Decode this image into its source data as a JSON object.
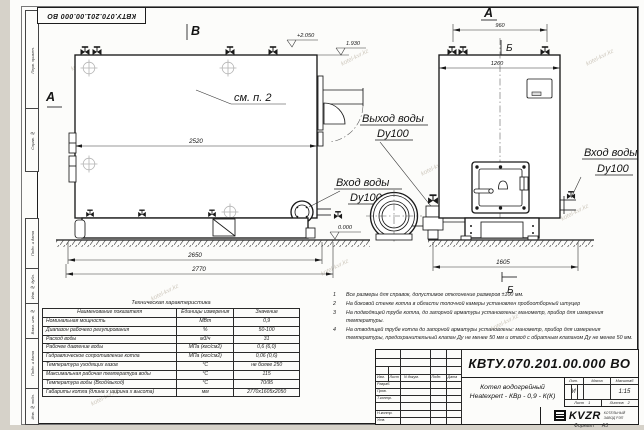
{
  "watermark": "kotel-kvr.kz",
  "stamp_top": "КВТУ.070.201.00.000  ВО",
  "frame_labels": [
    "Перв. примен.",
    "Справ. №",
    "Подп. и дата",
    "Инв. № дубл.",
    "Взам. инв. №",
    "Подп. и дата",
    "Инв. № подл."
  ],
  "drawing": {
    "view_labels": {
      "v_b": "В",
      "a_left": "А",
      "a_front": "А",
      "b_top": "Б",
      "b_bottom": "Б"
    },
    "callout": "см. п. 2",
    "dims": {
      "d2520": "2520",
      "d2650": "2650",
      "d2770": "2770",
      "d960": "960",
      "d1260": "1260",
      "d1605": "1605"
    },
    "elevations": {
      "top": "+2.050",
      "mid": "1.930",
      "zero": "0.000"
    },
    "ports": {
      "outlet_label": "Выход воды",
      "outlet_dn": "Dy100",
      "inlet_label": "Вход воды",
      "inlet_dn": "Dy100",
      "inlet2_label": "Вход воды",
      "inlet2_dn": "Dy100"
    }
  },
  "notes": [
    {
      "num": "1",
      "text": "Все размеры для справок, допустимое отклонение размеров ±100 мм."
    },
    {
      "num": "2",
      "text": "На боковой стенке котла в области топочной камеры установлен пробоотборный штуцер"
    },
    {
      "num": "3",
      "text": "На  подводящей трубе котла, до запорной арматуры установлены: манометр, прибор для измерения температуры."
    },
    {
      "num": "4",
      "text": "На отводящей трубе котла до запорной арматуры установлены: манометр, прибор для измерения температуры, предохранительный клапан Ду не менее 50 мм и отвод с обратным клапаном Ду не менее 50 мм."
    }
  ],
  "tech_table": {
    "title": "Техническая характеристика",
    "headers": [
      "Наименование показателя",
      "Единицы измерения",
      "Значение"
    ],
    "rows": [
      {
        "name": "Номинальная мощность",
        "unit": "МВт",
        "value": "0,9"
      },
      {
        "name": "Диапазон рабочего регулирования",
        "unit": "%",
        "value": "50-100"
      },
      {
        "name": "Расход воды",
        "unit": "м3/ч",
        "value": "31"
      },
      {
        "name": "Рабочее давление воды",
        "unit": "МПа (кгс/см2)",
        "value": "0,6 (6,0)"
      },
      {
        "name": "Гидравлическое сопротивление котла",
        "unit": "МПа (кгс/см2)",
        "value": "0,06 (0,6)"
      },
      {
        "name": "Температура уходящих газов",
        "unit": "°С",
        "value": "не более 250"
      },
      {
        "name": "Максимальная рабочая температура воды",
        "unit": "°С",
        "value": "115"
      },
      {
        "name": "Температура воды (Вход/выход)",
        "unit": "°С",
        "value": "70/95"
      },
      {
        "name": "Габариты котла (длина х ширина х высота)",
        "unit": "мм",
        "value": "2770х1605х2050"
      }
    ]
  },
  "title_block": {
    "doc_number": "КВТУ.070.201.00.000  ВО",
    "product_name_line1": "Котел водогрейный",
    "product_name_line2": "Heatexpert - КВр - 0,9 - К(К)",
    "col_headers": [
      "Изм.",
      "Лист",
      "N докум.",
      "Подп.",
      "Дата"
    ],
    "row_labels": [
      "Разраб.",
      "Пров.",
      "Т.контр.",
      "Н.контр.",
      "Утв."
    ],
    "lit_header": "Лит.",
    "lit_value": "И",
    "mass_header": "Масса",
    "mass_value": "",
    "scale_header": "Масштаб",
    "scale_value": "1:15",
    "sheet_label": "Лист",
    "sheet_value": "1",
    "sheets_label": "Листов",
    "sheets_value": "2",
    "company_logo": "KVZR",
    "company_line1": "КОТЕЛЬНЫЙ",
    "company_line2": "ЗАВОД РЭП",
    "format_label": "Формат",
    "format_value": "А3"
  }
}
